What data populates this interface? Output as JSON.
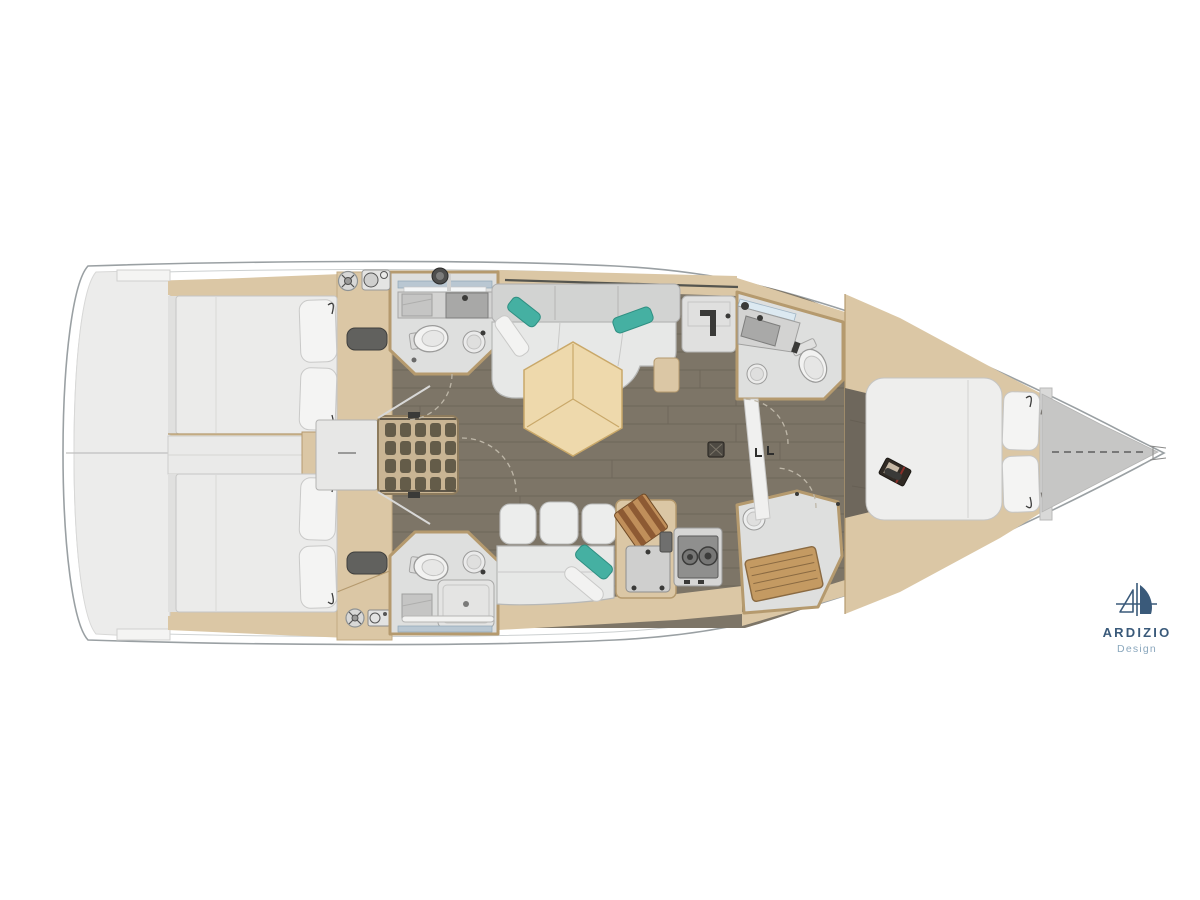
{
  "logo": {
    "title": "ARDIZIO",
    "subtitle": "Design"
  },
  "colors": {
    "background": "#ffffff",
    "hull_line": "#9aa0a3",
    "wood_trim": "#dbc7a5",
    "wood_trim_dark": "#b59a6e",
    "floor": "#7d7567",
    "floor_seam": "#5f584d",
    "floor_fwd": "#6e675c",
    "platform_gray": "#ececeb",
    "fixture_white": "#f1f1f0",
    "teal": "#45b0a2",
    "table_wood": "#eed9ac",
    "table_wood_line": "#c9a869",
    "teak": "#c49a62",
    "teak_dark": "#8a6a42",
    "dark_fitting": "#3a3a38",
    "mirror_blue": "#dce9f1",
    "foredeck_gray": "#c6c6c5",
    "stripe_wood": "#8d5a33",
    "stripe_wood_light": "#c08f5a",
    "logo_blue": "#3a5a7a",
    "logo_light": "#8aa7bd"
  }
}
